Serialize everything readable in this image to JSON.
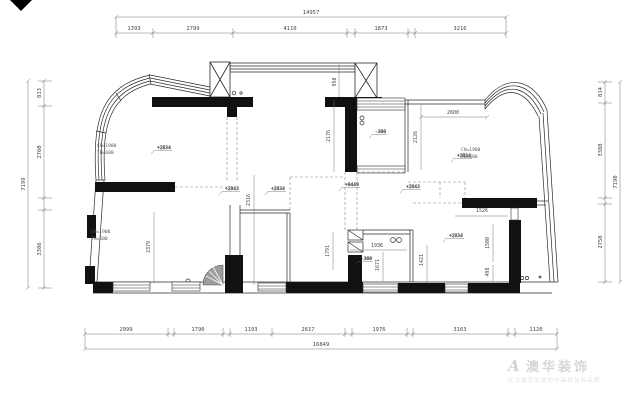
{
  "dimensions": {
    "top": {
      "total": "14957",
      "segments": [
        "1393",
        "2799",
        "4110",
        "1873",
        "3216"
      ]
    },
    "bottom": {
      "total": "16849",
      "segments": [
        "2999",
        "1790",
        "1193",
        "2617",
        "1976",
        "3163",
        "1120"
      ]
    },
    "left": {
      "total": "7199",
      "segments": [
        "813",
        "2760",
        "3386"
      ]
    },
    "right": {
      "total": "7190",
      "segments": [
        "814",
        "3388",
        "2758"
      ]
    }
  },
  "interior_dimensions": {
    "v950": "950",
    "v2176": "2176",
    "v2316": "2316",
    "v2600": "2600",
    "v2126": "2126",
    "v2379": "2379",
    "v1936": "1936",
    "v1671": "1671",
    "v1421": "1421",
    "v1526": "1526",
    "v1500": "1500",
    "v498": "498",
    "v1791": "1791"
  },
  "elevation_markers": [
    "+2834",
    "+2843",
    "+2834",
    "-300",
    "-300",
    "+2834",
    "+2834",
    "+0449",
    "+2843"
  ],
  "window_labels": [
    {
      "line1": "CH=1900",
      "line2": "TH=600"
    },
    {
      "line1": "CH=1900",
      "line2": "TH=600"
    },
    {
      "line1": "CH=1900",
      "line2": "TH=600"
    }
  ],
  "watermark": {
    "logo": "A",
    "brand": "澳华装饰",
    "tagline": "武汉最受欢迎的中高档装饰品牌"
  }
}
